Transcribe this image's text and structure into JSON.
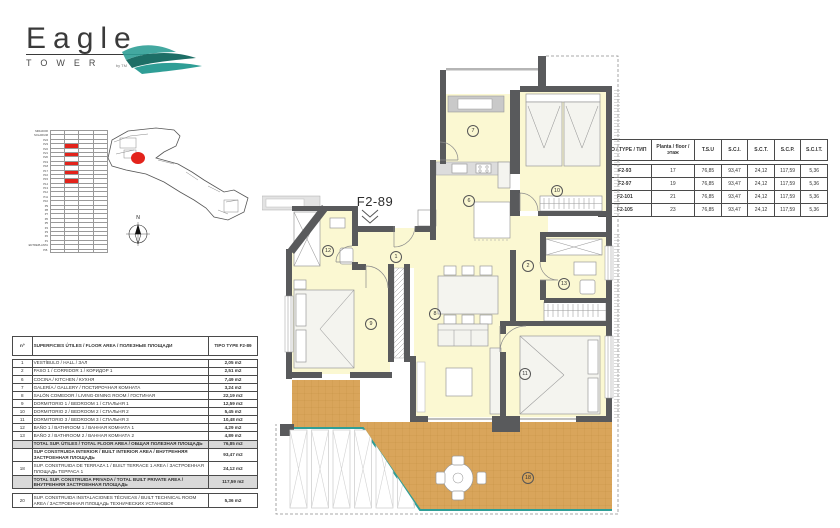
{
  "logo": {
    "title": "Eagle",
    "subtitle": "TOWER",
    "byline": "by TM"
  },
  "unit": {
    "label": "F2-89"
  },
  "spec_table": {
    "headers": [
      "TIPO / TYPE / ТИП",
      "Planta / floor / этаж",
      "T.S.U",
      "S.C.I.",
      "S.C.T.",
      "S.C.P.",
      "S.C.I.T."
    ],
    "rows": [
      [
        "F2-93",
        "17",
        "76,85",
        "93,47",
        "24,12",
        "117,59",
        "5,36"
      ],
      [
        "F2-97",
        "19",
        "76,85",
        "93,47",
        "24,12",
        "117,59",
        "5,36"
      ],
      [
        "F2-101",
        "21",
        "76,85",
        "93,47",
        "24,12",
        "117,59",
        "5,36"
      ],
      [
        "F2-105",
        "23",
        "76,85",
        "93,47",
        "24,12",
        "117,59",
        "5,36"
      ]
    ]
  },
  "area_table": {
    "headers": [
      "nº",
      "SUPERFICIES ÚTILES / FLOOR AREA / ПОЛЕЗНЫЕ ПЛОЩАДИ",
      "TIPO TYPE F2-89"
    ],
    "rows": [
      {
        "num": "1",
        "label": "VESTÍBULO / HALL / ЗАЛ",
        "value": "2,05 m2"
      },
      {
        "num": "2",
        "label": "PASO 1 / CORRIDOR 1 / КОРИДОР 1",
        "value": "2,51 m2"
      },
      {
        "num": "6",
        "label": "COCINA / KITCHEN / КУХНЯ",
        "value": "7,49 m2"
      },
      {
        "num": "7",
        "label": "GALERÍA / GALLERY / ПОСТИРОЧНАЯ КОМНАТА",
        "value": "3,24 m2"
      },
      {
        "num": "8",
        "label": "SALÓN COMEDOR / LIVING-DINING ROOM / ГОСТИНАЯ",
        "value": "22,19 m2"
      },
      {
        "num": "9",
        "label": "DORMITORIO 1 / BEDROOM 1 / СПАЛЬНЯ 1",
        "value": "12,59 m2"
      },
      {
        "num": "10",
        "label": "DORMITORIO 2 / BEDROOM 2 / СПАЛЬНЯ 2",
        "value": "5,45 m2"
      },
      {
        "num": "11",
        "label": "DORMITORIO 3 / BEDROOM 3 / СПАЛЬНЯ 3",
        "value": "10,48 m2"
      },
      {
        "num": "12",
        "label": "BAÑO 1 / BATHROOM 1 / ВАННАЯ КОМНАТА 1",
        "value": "4,29 m2"
      },
      {
        "num": "13",
        "label": "BAÑO 2 / BATHROOM 2 / ВАННАЯ КОМНАТА 2",
        "value": "4,89 m2"
      },
      {
        "num": "",
        "label": "TOTAL SUP. ÚTILES / TOTAL FLOOR AREA / ОБЩАЯ ПОЛЕЗНАЯ ПЛОЩАДЬ",
        "value": "76,85 m2",
        "total": true
      },
      {
        "num": "",
        "label": "SUP CONSTRUIDA INTERIOR / BUILT INTERIOR AREA / ВНУТРЕННЯЯ ЗАСТРОЕННАЯ ПЛОЩАДЬ",
        "value": "93,47 m2",
        "bold": true
      },
      {
        "num": "18",
        "label": "SUP. CONSTRUIDA DE TERRAZA 1 / BUILT TERRACE 1 AREA / ЗАСТРОЕННАЯ ПЛОЩАДЬ ТЕРРАСА 1",
        "value": "24,12 m2"
      },
      {
        "num": "",
        "label": "TOTAL SUP. CONSTRUIDA PRIVADA / TOTAL BUILT PRIVATE AREA / ВНУТРЕННЯЯ ЗАСТРОЕННАЯ ПЛОЩАДЬ",
        "value": "117,59 m2",
        "total": true
      }
    ],
    "tech_row": {
      "num": "20",
      "label": "SUP. CONSTRUIDA INSTALACIONES TÉCNICAS / BUILT TECHNICAL ROOM AREA / ЗАСТРОЕННАЯ ПЛОЩАДЬ ТЕХНИЧЕСКИХ УСТАНОВОК",
      "value": "5,36 m2"
    }
  },
  "elevation": {
    "floors": [
      "MIRADOR",
      "SOLARIUM",
      "P24",
      "P23",
      "P22",
      "P21",
      "P20",
      "P19",
      "P18",
      "P17",
      "P16",
      "P15",
      "P14",
      "P13",
      "P12",
      "P11",
      "P10",
      "P9",
      "P8",
      "P7",
      "P6",
      "P5",
      "P4",
      "P3",
      "P2",
      "P1",
      "ENTREPLANTA",
      "P.B."
    ],
    "highlighted": [
      "P23",
      "P21",
      "P19",
      "P17",
      "P15"
    ]
  },
  "site": {
    "north_label": "N"
  },
  "plan": {
    "rooms": {
      "hall": "1",
      "corridor": "2",
      "kitchen": "6",
      "gallery": "7",
      "living": "8",
      "bed1": "9",
      "bed2": "10",
      "bed3": "11",
      "bath1": "12",
      "bath2": "13",
      "terrace": "18"
    }
  },
  "colors": {
    "teal": "#2f9e96",
    "red": "#e3231b",
    "wall": "#595a5c",
    "room_fill": "#fbf8d2",
    "terrace_fill": "#d9a55b",
    "furniture_stroke": "#9a9a9a",
    "table_border": "#4a4a4a"
  }
}
